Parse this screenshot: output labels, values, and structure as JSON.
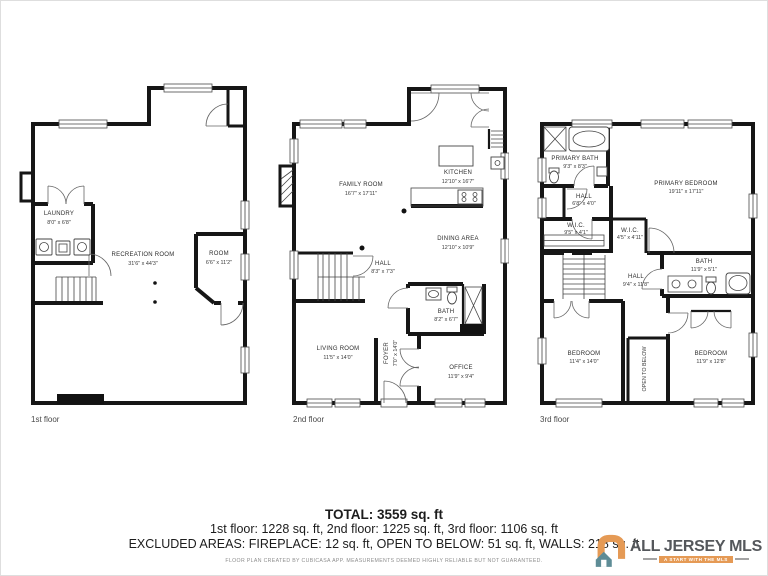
{
  "floors": {
    "f1": {
      "label": "1st floor",
      "rooms": {
        "laundry": {
          "name": "LAUNDRY",
          "dims": "8'0\" x 6'8\""
        },
        "recreation": {
          "name": "RECREATION ROOM",
          "dims": "31'6\" x 44'3\""
        },
        "room": {
          "name": "ROOM",
          "dims": "6'6\" x 11'2\""
        }
      }
    },
    "f2": {
      "label": "2nd floor",
      "rooms": {
        "family": {
          "name": "FAMILY ROOM",
          "dims": "16'7\" x 17'11\""
        },
        "kitchen": {
          "name": "KITCHEN",
          "dims": "12'10\" x 16'7\""
        },
        "dining": {
          "name": "DINING AREA",
          "dims": "12'10\" x 10'9\""
        },
        "hall": {
          "name": "HALL",
          "dims": "8'3\" x 7'3\""
        },
        "bath": {
          "name": "BATH",
          "dims": "8'2\" x 6'7\""
        },
        "living": {
          "name": "LIVING ROOM",
          "dims": "11'5\" x 14'0\""
        },
        "foyer": {
          "name": "FOYER",
          "dims": "7'0\" x 14'0\""
        },
        "office": {
          "name": "OFFICE",
          "dims": "11'9\" x 9'4\""
        }
      }
    },
    "f3": {
      "label": "3rd floor",
      "rooms": {
        "primary_bath": {
          "name": "PRIMARY BATH",
          "dims": "9'3\" x 8'3\""
        },
        "primary_bedroom": {
          "name": "PRIMARY BEDROOM",
          "dims": "19'11\" x 17'11\""
        },
        "hall_upper": {
          "name": "HALL",
          "dims": "6'8\" x 4'0\""
        },
        "wic_left": {
          "name": "W.I.C.",
          "dims": "9'5\" x 4'1\""
        },
        "wic_right": {
          "name": "W.I.C.",
          "dims": "4'5\" x 4'11\""
        },
        "bath": {
          "name": "BATH",
          "dims": "11'9\" x 5'1\""
        },
        "hall": {
          "name": "HALL",
          "dims": "9'4\" x 11'8\""
        },
        "bedroom_left": {
          "name": "BEDROOM",
          "dims": "11'4\" x 14'0\""
        },
        "open_below": {
          "name": "OPEN TO BELOW"
        },
        "bedroom_right": {
          "name": "BEDROOM",
          "dims": "11'9\" x 12'8\""
        }
      }
    }
  },
  "summary": {
    "total": "TOTAL: 3559 sq. ft",
    "per_floor": "1st floor: 1228 sq. ft, 2nd floor: 1225 sq. ft, 3rd floor: 1106 sq. ft",
    "excluded": "EXCLUDED AREAS: FIREPLACE: 12 sq. ft, OPEN TO BELOW: 51 sq. ft, WALLS: 218 sq. ft",
    "disclaimer": "FLOOR PLAN CREATED BY CUBICASA APP. MEASUREMENTS DEEMED HIGHLY RELIABLE BUT NOT GUARANTEED."
  },
  "logo": {
    "name": "ALL JERSEY MLS",
    "tagline": "A START WITH THE MLS",
    "colors": {
      "orange": "#e59a55",
      "teal": "#5e8c96",
      "text": "#54575b"
    }
  }
}
